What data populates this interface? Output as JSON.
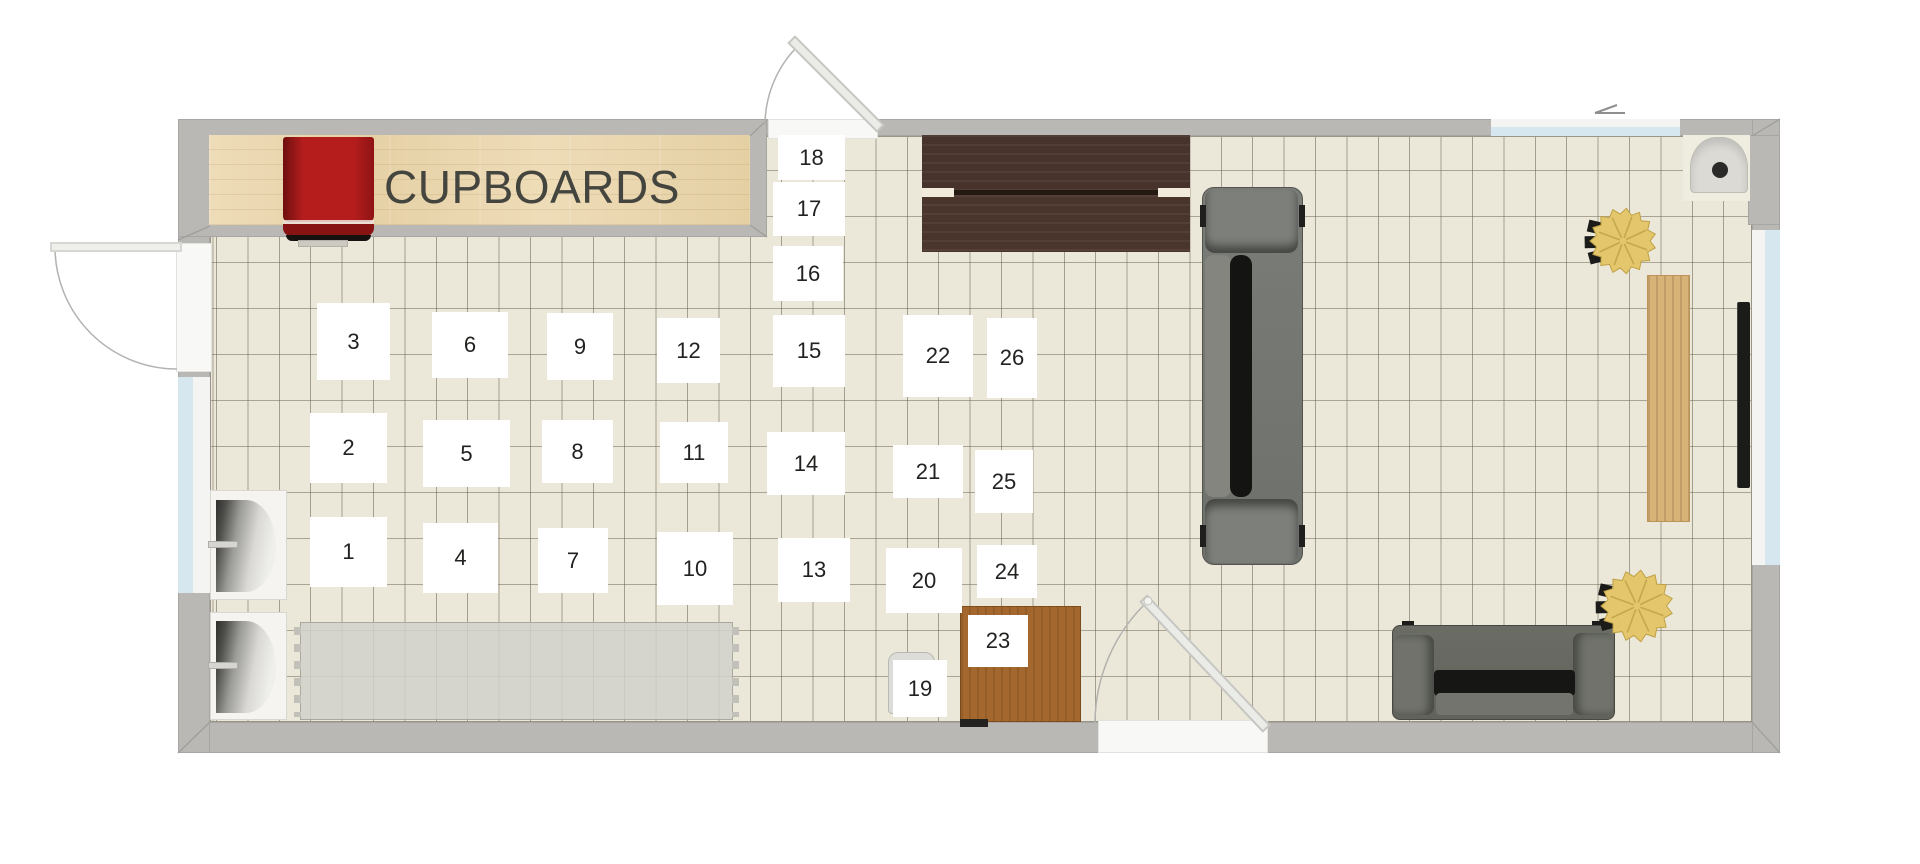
{
  "plan": {
    "cupboards_label": "CUPBOARDS",
    "markers": [
      {
        "n": "1",
        "x": 310,
        "y": 517,
        "w": 77,
        "h": 70
      },
      {
        "n": "2",
        "x": 310,
        "y": 413,
        "w": 77,
        "h": 70
      },
      {
        "n": "3",
        "x": 317,
        "y": 303,
        "w": 73,
        "h": 77
      },
      {
        "n": "4",
        "x": 423,
        "y": 523,
        "w": 75,
        "h": 70
      },
      {
        "n": "5",
        "x": 423,
        "y": 420,
        "w": 87,
        "h": 67
      },
      {
        "n": "6",
        "x": 432,
        "y": 312,
        "w": 76,
        "h": 66
      },
      {
        "n": "7",
        "x": 538,
        "y": 528,
        "w": 70,
        "h": 65
      },
      {
        "n": "8",
        "x": 542,
        "y": 420,
        "w": 71,
        "h": 63
      },
      {
        "n": "9",
        "x": 547,
        "y": 313,
        "w": 66,
        "h": 67
      },
      {
        "n": "10",
        "x": 657,
        "y": 532,
        "w": 76,
        "h": 73
      },
      {
        "n": "11",
        "x": 660,
        "y": 422,
        "w": 68,
        "h": 61
      },
      {
        "n": "12",
        "x": 657,
        "y": 318,
        "w": 63,
        "h": 65
      },
      {
        "n": "13",
        "x": 778,
        "y": 538,
        "w": 72,
        "h": 64
      },
      {
        "n": "14",
        "x": 767,
        "y": 432,
        "w": 78,
        "h": 63
      },
      {
        "n": "15",
        "x": 773,
        "y": 315,
        "w": 72,
        "h": 72
      },
      {
        "n": "16",
        "x": 773,
        "y": 246,
        "w": 70,
        "h": 55
      },
      {
        "n": "17",
        "x": 773,
        "y": 182,
        "w": 72,
        "h": 54
      },
      {
        "n": "18",
        "x": 778,
        "y": 135,
        "w": 67,
        "h": 45
      },
      {
        "n": "19",
        "x": 893,
        "y": 660,
        "w": 54,
        "h": 57
      },
      {
        "n": "20",
        "x": 886,
        "y": 548,
        "w": 76,
        "h": 65
      },
      {
        "n": "21",
        "x": 893,
        "y": 445,
        "w": 70,
        "h": 53
      },
      {
        "n": "22",
        "x": 903,
        "y": 315,
        "w": 70,
        "h": 82
      },
      {
        "n": "23",
        "x": 968,
        "y": 615,
        "w": 60,
        "h": 52
      },
      {
        "n": "24",
        "x": 977,
        "y": 545,
        "w": 60,
        "h": 53
      },
      {
        "n": "25",
        "x": 975,
        "y": 450,
        "w": 58,
        "h": 63
      },
      {
        "n": "26",
        "x": 987,
        "y": 318,
        "w": 50,
        "h": 80
      }
    ],
    "plants": [
      {
        "cx": 1623,
        "cy": 241,
        "r": 33
      },
      {
        "cx": 1637,
        "cy": 606,
        "r": 36
      }
    ],
    "colors": {
      "floor": "#ece8d9",
      "grid_line": "#68604e",
      "wall": "#b9b8b4",
      "cupboard_wood": "#ead7b0",
      "red_runner": "#b11b1b",
      "dark_table": "#46312a",
      "sofa_gray": "#6f716c",
      "plant_gold": "#e4c76d",
      "window_glass": "#d6e7ef",
      "desk_wood": "#a4682e",
      "sideboard_wood": "#d8b378"
    }
  }
}
